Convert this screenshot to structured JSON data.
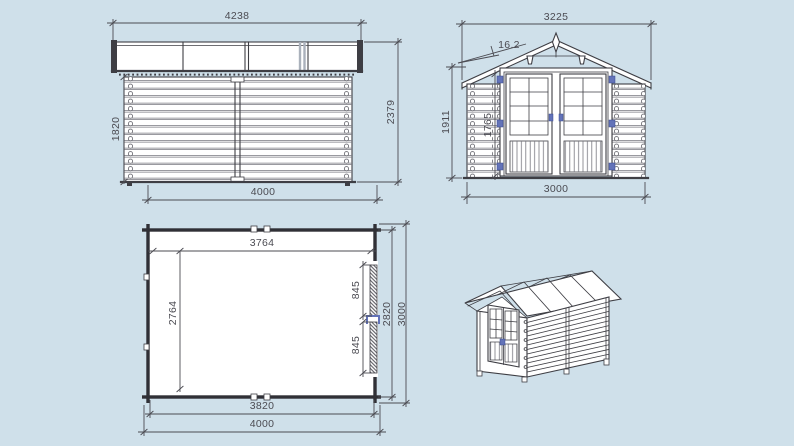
{
  "colors": {
    "bg": "#cfe0ea",
    "paper": "#ffffff",
    "ink": "#3e3e44",
    "dim": "#4b4b52",
    "accent": "#6373b9"
  },
  "views": {
    "side_elevation": {
      "dim_roof_width": "4238",
      "dim_wall_height": "1820",
      "dim_total_height": "2379",
      "dim_wall_width": "4000"
    },
    "front_elevation": {
      "dim_roof_width": "3225",
      "dim_roof_angle": "16.2",
      "dim_total_height": "1911",
      "dim_door_height": "1765",
      "dim_wall_width": "3000"
    },
    "floor_plan": {
      "dim_inner_width": "3764",
      "dim_inner_depth": "2764",
      "dim_door_leaf_a": "845",
      "dim_door_leaf_b": "845",
      "dim_wall_depth": "2820",
      "dim_total_depth": "3000",
      "dim_wall_width": "3820",
      "dim_total_width": "4000"
    }
  }
}
